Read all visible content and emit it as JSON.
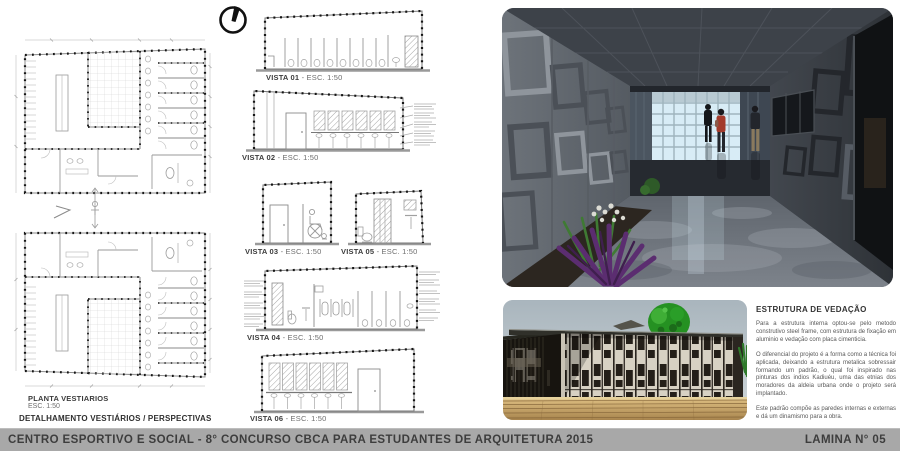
{
  "footer": {
    "title": "CENTRO ESPORTIVO E SOCIAL - 8° CONCURSO CBCA PARA ESTUDANTES DE ARQUITETURA 2015",
    "sheet_number": "LAMINA N° 05"
  },
  "plans": {
    "title": "PLANTA VESTIARIOS",
    "scale": "ESC. 1:50",
    "section_caption": "DETALHAMENTO VESTIÁRIOS / PERSPECTIVAS"
  },
  "vistas": [
    {
      "name": "VISTA 01",
      "scale": "- ESC. 1:50"
    },
    {
      "name": "VISTA 02",
      "scale": "- ESC. 1:50"
    },
    {
      "name": "VISTA 03",
      "scale": "- ESC. 1:50"
    },
    {
      "name": "VISTA 04",
      "scale": "- ESC. 1:50"
    },
    {
      "name": "VISTA 05",
      "scale": "- ESC. 1:50"
    },
    {
      "name": "VISTA 06",
      "scale": "- ESC. 1:50"
    }
  ],
  "notes": {
    "heading": "ESTRUTURA DE VEDAÇÃO",
    "paragraph_1": "Para a estrutura interna optou-se pelo metodo construtivo steel frame, com estrutura de fixação em aluminio e vedação com placa cimenticia.",
    "paragraph_2": "O diferencial do projeto é a forma como a técnica foi aplicada, deixando a estrutura metalica sobressair formando um padrão, o qual foi inspirado nas pinturas dos indios Kadiuéu, uma das etnias dos moradores da aldeia urbana onde o projeto será implantado.",
    "paragraph_3": "Este padrão compõe as paredes internas e externas e dá um dinamismo para a obra."
  },
  "icons": {
    "north_arrow": "north-arrow"
  },
  "colors": {
    "footer_bg": "#a8a8a8",
    "footer_text": "#3d3d3d",
    "facade_panel": "#d7d1c3",
    "facade_pattern": "#211d18",
    "sky": "#b9c3c9",
    "tree_green": "#2a8f28",
    "corridor_wall": "#666c73",
    "corridor_window": "#d8ecf6",
    "deck_wood": "#caa366",
    "plant_purple": "#5b2d70"
  }
}
